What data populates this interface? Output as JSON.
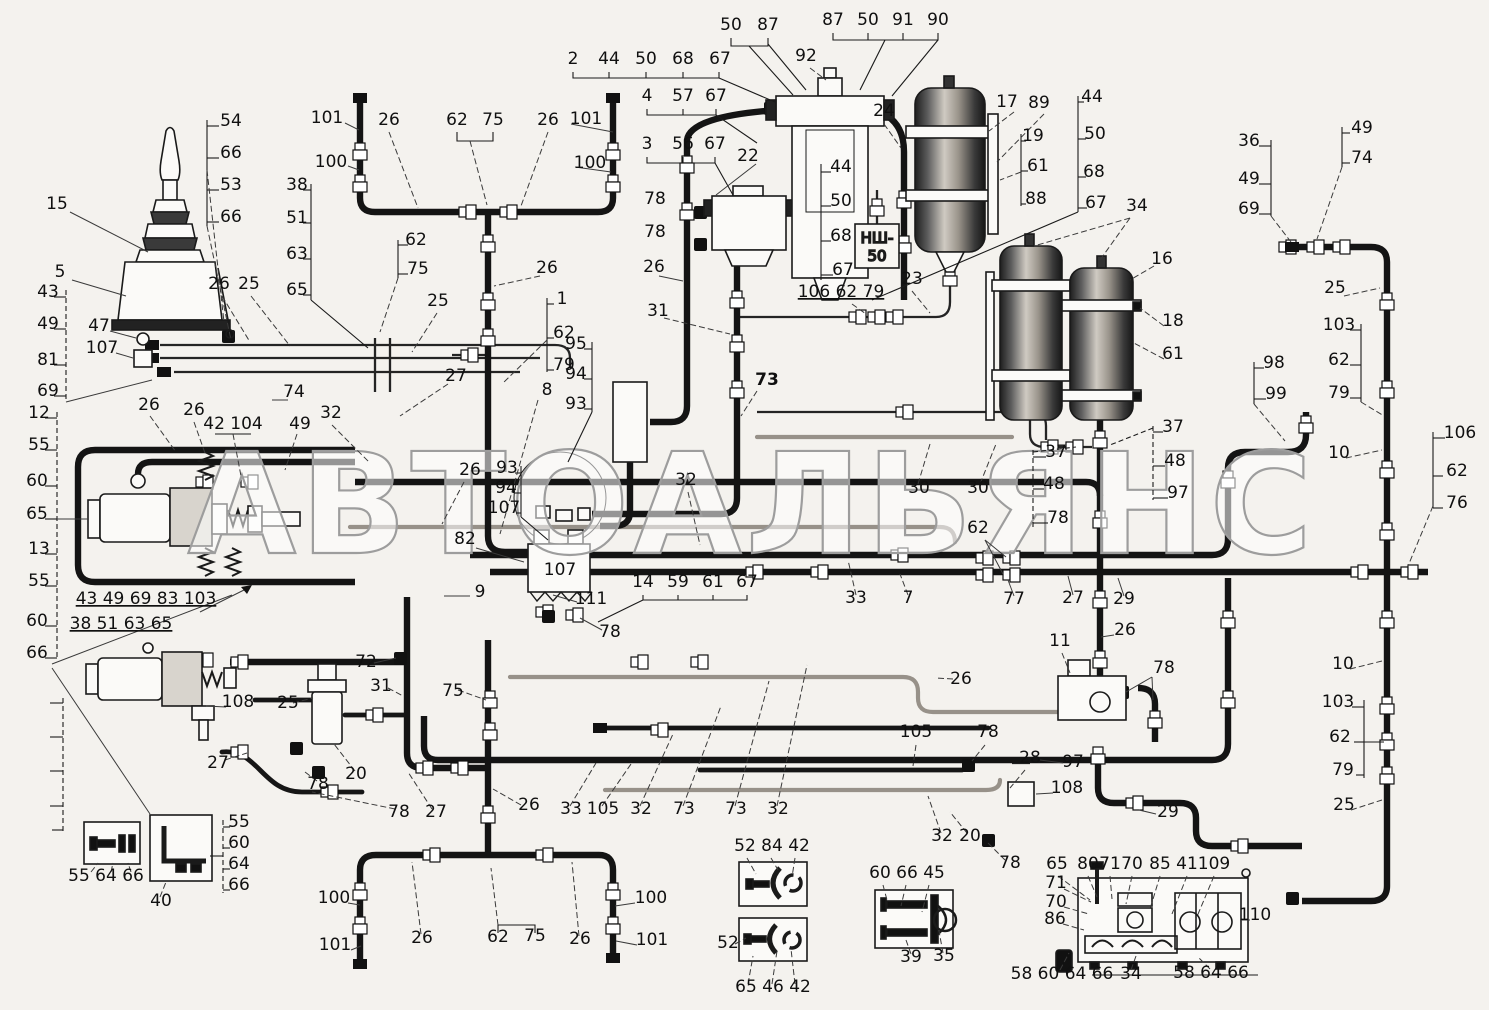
{
  "watermark": "АВТОАЛЬЯНС",
  "nsh": {
    "line1": "НШ-",
    "line2": "50"
  },
  "labels": [
    {
      "t": "50",
      "x": 731,
      "y": 30
    },
    {
      "t": "87",
      "x": 768,
      "y": 30
    },
    {
      "t": "87",
      "x": 833,
      "y": 25
    },
    {
      "t": "50",
      "x": 868,
      "y": 25
    },
    {
      "t": "91",
      "x": 903,
      "y": 25
    },
    {
      "t": "90",
      "x": 938,
      "y": 25
    },
    {
      "t": "92",
      "x": 806,
      "y": 61
    },
    {
      "t": "2",
      "x": 573,
      "y": 64
    },
    {
      "t": "44",
      "x": 609,
      "y": 64
    },
    {
      "t": "50",
      "x": 646,
      "y": 64
    },
    {
      "t": "68",
      "x": 683,
      "y": 64
    },
    {
      "t": "67",
      "x": 720,
      "y": 64
    },
    {
      "t": "4",
      "x": 647,
      "y": 101
    },
    {
      "t": "57",
      "x": 683,
      "y": 101
    },
    {
      "t": "67",
      "x": 716,
      "y": 101
    },
    {
      "t": "3",
      "x": 647,
      "y": 149
    },
    {
      "t": "56",
      "x": 683,
      "y": 149
    },
    {
      "t": "67",
      "x": 715,
      "y": 149
    },
    {
      "t": "22",
      "x": 748,
      "y": 161
    },
    {
      "t": "24",
      "x": 884,
      "y": 116
    },
    {
      "t": "78",
      "x": 655,
      "y": 204
    },
    {
      "t": "78",
      "x": 655,
      "y": 237
    },
    {
      "t": "101",
      "x": 327,
      "y": 123
    },
    {
      "t": "100",
      "x": 331,
      "y": 167
    },
    {
      "t": "26",
      "x": 389,
      "y": 125
    },
    {
      "t": "62",
      "x": 457,
      "y": 125
    },
    {
      "t": "75",
      "x": 493,
      "y": 125
    },
    {
      "t": "26",
      "x": 548,
      "y": 125
    },
    {
      "t": "101",
      "x": 586,
      "y": 124
    },
    {
      "t": "100",
      "x": 590,
      "y": 168
    },
    {
      "t": "54",
      "x": 231,
      "y": 126
    },
    {
      "t": "66",
      "x": 231,
      "y": 158
    },
    {
      "t": "53",
      "x": 231,
      "y": 190
    },
    {
      "t": "66",
      "x": 231,
      "y": 222
    },
    {
      "t": "15",
      "x": 57,
      "y": 209
    },
    {
      "t": "5",
      "x": 60,
      "y": 277
    },
    {
      "t": "43",
      "x": 48,
      "y": 297
    },
    {
      "t": "49",
      "x": 48,
      "y": 329
    },
    {
      "t": "81",
      "x": 48,
      "y": 365
    },
    {
      "t": "69",
      "x": 48,
      "y": 396
    },
    {
      "t": "47",
      "x": 99,
      "y": 331
    },
    {
      "t": "107",
      "x": 102,
      "y": 353
    },
    {
      "t": "26",
      "x": 219,
      "y": 289
    },
    {
      "t": "25",
      "x": 249,
      "y": 289
    },
    {
      "t": "38",
      "x": 297,
      "y": 190
    },
    {
      "t": "51",
      "x": 297,
      "y": 223
    },
    {
      "t": "63",
      "x": 297,
      "y": 259
    },
    {
      "t": "65",
      "x": 297,
      "y": 295
    },
    {
      "t": "62",
      "x": 416,
      "y": 245
    },
    {
      "t": "75",
      "x": 418,
      "y": 274
    },
    {
      "t": "25",
      "x": 438,
      "y": 306
    },
    {
      "t": "26",
      "x": 547,
      "y": 273
    },
    {
      "t": "1",
      "x": 562,
      "y": 304
    },
    {
      "t": "62",
      "x": 564,
      "y": 338
    },
    {
      "t": "79",
      "x": 564,
      "y": 370
    },
    {
      "t": "27",
      "x": 456,
      "y": 381
    },
    {
      "t": "8",
      "x": 547,
      "y": 395
    },
    {
      "t": "95",
      "x": 576,
      "y": 349
    },
    {
      "t": "94",
      "x": 576,
      "y": 379
    },
    {
      "t": "93",
      "x": 576,
      "y": 409
    },
    {
      "t": "93",
      "x": 507,
      "y": 473
    },
    {
      "t": "94",
      "x": 506,
      "y": 493
    },
    {
      "t": "107",
      "x": 504,
      "y": 513
    },
    {
      "t": "82",
      "x": 465,
      "y": 544
    },
    {
      "t": "9",
      "x": 480,
      "y": 597
    },
    {
      "t": "26",
      "x": 470,
      "y": 475
    },
    {
      "t": "12",
      "x": 39,
      "y": 418
    },
    {
      "t": "55",
      "x": 39,
      "y": 450
    },
    {
      "t": "60",
      "x": 37,
      "y": 486
    },
    {
      "t": "65",
      "x": 37,
      "y": 519
    },
    {
      "t": "13",
      "x": 39,
      "y": 554
    },
    {
      "t": "55",
      "x": 39,
      "y": 586
    },
    {
      "t": "60",
      "x": 37,
      "y": 626
    },
    {
      "t": "66",
      "x": 37,
      "y": 658
    },
    {
      "t": "26",
      "x": 149,
      "y": 410
    },
    {
      "t": "26",
      "x": 194,
      "y": 415
    },
    {
      "t": "42 104",
      "x": 233,
      "y": 429
    },
    {
      "t": "74",
      "x": 294,
      "y": 397
    },
    {
      "t": "49",
      "x": 300,
      "y": 429
    },
    {
      "t": "32",
      "x": 331,
      "y": 418
    },
    {
      "t": "43 49 69 83 103",
      "x": 146,
      "y": 604,
      "u": 1
    },
    {
      "t": "38 51 63 65",
      "x": 121,
      "y": 629,
      "u": 1
    },
    {
      "t": "31",
      "x": 658,
      "y": 316
    },
    {
      "t": "26",
      "x": 654,
      "y": 272
    },
    {
      "t": "73",
      "x": 767,
      "y": 385,
      "b": 1
    },
    {
      "t": "32",
      "x": 686,
      "y": 485
    },
    {
      "t": "106 62 79",
      "x": 841,
      "y": 297,
      "u": 1
    },
    {
      "t": "23",
      "x": 912,
      "y": 284
    },
    {
      "t": "44",
      "x": 841,
      "y": 172
    },
    {
      "t": "50",
      "x": 841,
      "y": 206
    },
    {
      "t": "68",
      "x": 841,
      "y": 241
    },
    {
      "t": "67",
      "x": 843,
      "y": 275
    },
    {
      "t": "17",
      "x": 1007,
      "y": 107
    },
    {
      "t": "89",
      "x": 1039,
      "y": 108
    },
    {
      "t": "19",
      "x": 1033,
      "y": 141
    },
    {
      "t": "61",
      "x": 1038,
      "y": 171
    },
    {
      "t": "88",
      "x": 1036,
      "y": 204
    },
    {
      "t": "44",
      "x": 1092,
      "y": 102
    },
    {
      "t": "50",
      "x": 1095,
      "y": 139
    },
    {
      "t": "68",
      "x": 1094,
      "y": 177
    },
    {
      "t": "67",
      "x": 1096,
      "y": 208
    },
    {
      "t": "34",
      "x": 1137,
      "y": 211
    },
    {
      "t": "16",
      "x": 1162,
      "y": 264
    },
    {
      "t": "18",
      "x": 1173,
      "y": 326
    },
    {
      "t": "61",
      "x": 1173,
      "y": 359
    },
    {
      "t": "30",
      "x": 919,
      "y": 493
    },
    {
      "t": "30",
      "x": 978,
      "y": 493
    },
    {
      "t": "37",
      "x": 1056,
      "y": 457
    },
    {
      "t": "48",
      "x": 1054,
      "y": 489
    },
    {
      "t": "78",
      "x": 1058,
      "y": 523
    },
    {
      "t": "37",
      "x": 1173,
      "y": 432
    },
    {
      "t": "48",
      "x": 1175,
      "y": 466
    },
    {
      "t": "97",
      "x": 1178,
      "y": 498
    },
    {
      "t": "98",
      "x": 1274,
      "y": 368
    },
    {
      "t": "99",
      "x": 1276,
      "y": 399
    },
    {
      "t": "36",
      "x": 1249,
      "y": 146
    },
    {
      "t": "49",
      "x": 1249,
      "y": 184
    },
    {
      "t": "69",
      "x": 1249,
      "y": 214
    },
    {
      "t": "49",
      "x": 1362,
      "y": 133
    },
    {
      "t": "74",
      "x": 1362,
      "y": 163
    },
    {
      "t": "25",
      "x": 1335,
      "y": 293
    },
    {
      "t": "103",
      "x": 1339,
      "y": 330
    },
    {
      "t": "62",
      "x": 1339,
      "y": 365
    },
    {
      "t": "79",
      "x": 1339,
      "y": 398
    },
    {
      "t": "10",
      "x": 1339,
      "y": 458
    },
    {
      "t": "106",
      "x": 1460,
      "y": 438
    },
    {
      "t": "62",
      "x": 1457,
      "y": 476
    },
    {
      "t": "76",
      "x": 1457,
      "y": 508
    },
    {
      "t": "10",
      "x": 1343,
      "y": 669
    },
    {
      "t": "103",
      "x": 1338,
      "y": 707
    },
    {
      "t": "62",
      "x": 1340,
      "y": 742
    },
    {
      "t": "79",
      "x": 1343,
      "y": 775
    },
    {
      "t": "25",
      "x": 1344,
      "y": 810
    },
    {
      "t": "62",
      "x": 978,
      "y": 533
    },
    {
      "t": "77",
      "x": 1014,
      "y": 604
    },
    {
      "t": "27",
      "x": 1073,
      "y": 603
    },
    {
      "t": "29",
      "x": 1124,
      "y": 604
    },
    {
      "t": "33",
      "x": 856,
      "y": 603
    },
    {
      "t": "7",
      "x": 908,
      "y": 603
    },
    {
      "t": "14",
      "x": 643,
      "y": 587
    },
    {
      "t": "59",
      "x": 678,
      "y": 587
    },
    {
      "t": "61",
      "x": 713,
      "y": 587
    },
    {
      "t": "67",
      "x": 747,
      "y": 587
    },
    {
      "t": "111",
      "x": 591,
      "y": 604
    },
    {
      "t": "78",
      "x": 610,
      "y": 637
    },
    {
      "t": "26",
      "x": 1125,
      "y": 635
    },
    {
      "t": "11",
      "x": 1060,
      "y": 646
    },
    {
      "t": "78",
      "x": 1164,
      "y": 673
    },
    {
      "t": "26",
      "x": 961,
      "y": 684
    },
    {
      "t": "105",
      "x": 916,
      "y": 737
    },
    {
      "t": "78",
      "x": 988,
      "y": 737
    },
    {
      "t": "28",
      "x": 1030,
      "y": 763
    },
    {
      "t": "97",
      "x": 1073,
      "y": 767
    },
    {
      "t": "108",
      "x": 1067,
      "y": 793
    },
    {
      "t": "29",
      "x": 1168,
      "y": 817
    },
    {
      "t": "32",
      "x": 942,
      "y": 841
    },
    {
      "t": "20",
      "x": 970,
      "y": 841
    },
    {
      "t": "78",
      "x": 1010,
      "y": 868
    },
    {
      "t": "72",
      "x": 366,
      "y": 667
    },
    {
      "t": "31",
      "x": 381,
      "y": 691
    },
    {
      "t": "108",
      "x": 238,
      "y": 707
    },
    {
      "t": "25",
      "x": 288,
      "y": 708
    },
    {
      "t": "75",
      "x": 453,
      "y": 696
    },
    {
      "t": "27",
      "x": 218,
      "y": 768
    },
    {
      "t": "78",
      "x": 318,
      "y": 789
    },
    {
      "t": "20",
      "x": 356,
      "y": 779
    },
    {
      "t": "78",
      "x": 399,
      "y": 817
    },
    {
      "t": "27",
      "x": 436,
      "y": 817
    },
    {
      "t": "26",
      "x": 529,
      "y": 810
    },
    {
      "t": "33",
      "x": 571,
      "y": 814
    },
    {
      "t": "105",
      "x": 603,
      "y": 814
    },
    {
      "t": "32",
      "x": 641,
      "y": 814
    },
    {
      "t": "73",
      "x": 684,
      "y": 814
    },
    {
      "t": "73",
      "x": 736,
      "y": 814
    },
    {
      "t": "32",
      "x": 778,
      "y": 814
    },
    {
      "t": "55",
      "x": 239,
      "y": 827
    },
    {
      "t": "60",
      "x": 239,
      "y": 848
    },
    {
      "t": "64",
      "x": 239,
      "y": 869
    },
    {
      "t": "66",
      "x": 239,
      "y": 890
    },
    {
      "t": "55 64 66",
      "x": 106,
      "y": 881
    },
    {
      "t": "40",
      "x": 161,
      "y": 906
    },
    {
      "t": "100",
      "x": 334,
      "y": 903
    },
    {
      "t": "101",
      "x": 335,
      "y": 950
    },
    {
      "t": "26",
      "x": 422,
      "y": 943
    },
    {
      "t": "62",
      "x": 498,
      "y": 942
    },
    {
      "t": "75",
      "x": 535,
      "y": 941
    },
    {
      "t": "26",
      "x": 580,
      "y": 944
    },
    {
      "t": "100",
      "x": 651,
      "y": 903
    },
    {
      "t": "101",
      "x": 652,
      "y": 945
    },
    {
      "t": "52 84 42",
      "x": 772,
      "y": 851
    },
    {
      "t": "52",
      "x": 728,
      "y": 948
    },
    {
      "t": "65 46 42",
      "x": 773,
      "y": 992
    },
    {
      "t": "60 66 45",
      "x": 907,
      "y": 878
    },
    {
      "t": "39",
      "x": 911,
      "y": 962
    },
    {
      "t": "35",
      "x": 944,
      "y": 961
    },
    {
      "t": "65",
      "x": 1057,
      "y": 869
    },
    {
      "t": "80",
      "x": 1088,
      "y": 869
    },
    {
      "t": "71",
      "x": 1110,
      "y": 869
    },
    {
      "t": "70",
      "x": 1132,
      "y": 869
    },
    {
      "t": "85",
      "x": 1160,
      "y": 869
    },
    {
      "t": "41",
      "x": 1187,
      "y": 869
    },
    {
      "t": "109",
      "x": 1214,
      "y": 869
    },
    {
      "t": "71",
      "x": 1056,
      "y": 888
    },
    {
      "t": "70",
      "x": 1056,
      "y": 907
    },
    {
      "t": "86",
      "x": 1055,
      "y": 924
    },
    {
      "t": "110",
      "x": 1255,
      "y": 920
    },
    {
      "t": "58 60 64 66",
      "x": 1062,
      "y": 979
    },
    {
      "t": "34",
      "x": 1131,
      "y": 979
    },
    {
      "t": "58 64 66",
      "x": 1211,
      "y": 978
    },
    {
      "t": "107",
      "x": 560,
      "y": 575,
      "s": 20
    }
  ]
}
